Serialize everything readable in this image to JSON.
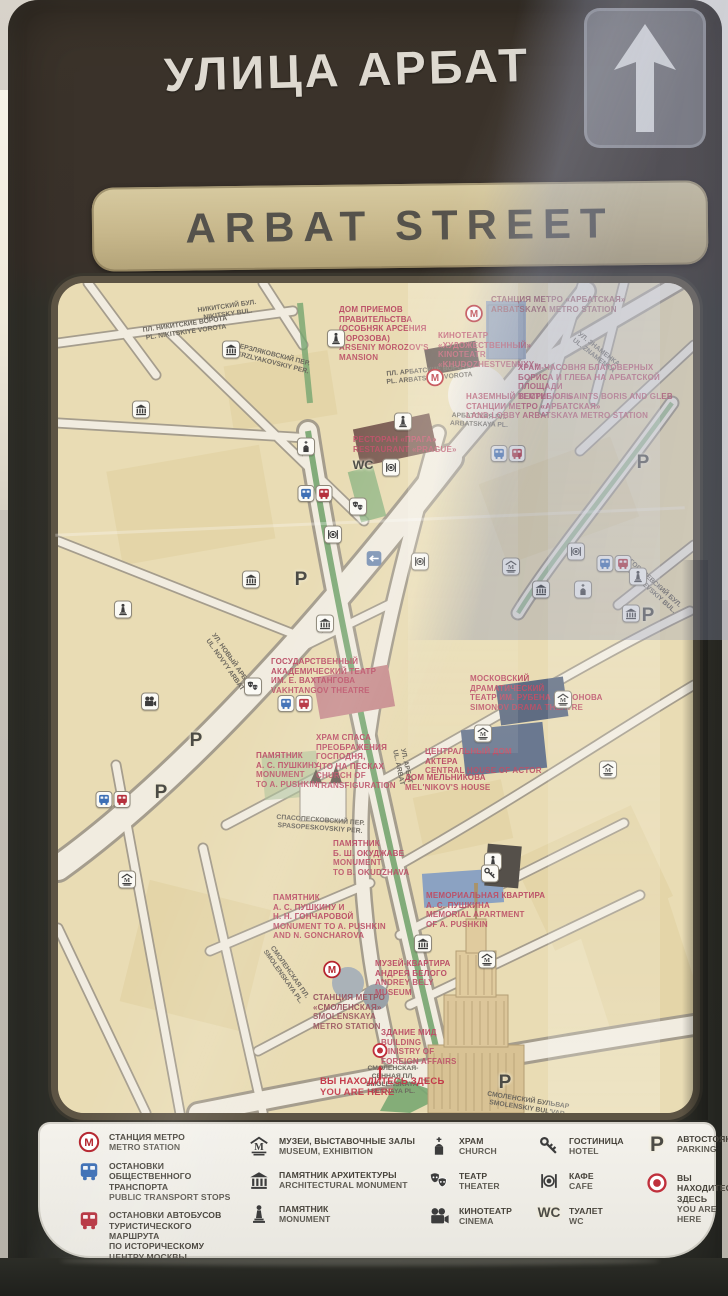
{
  "sign": {
    "title_ru": "УЛИЦА АРБАТ",
    "title_en": "ARBAT STREET",
    "arrow_icon": "up-arrow"
  },
  "colors": {
    "frame": "#2e2f29",
    "header_brown": "#3a322a",
    "gold": "#c7b78b",
    "map_cream": "#e9dcb4",
    "poi_red": "#bc5168",
    "metro_red": "#b5242e",
    "green": "#76a56f",
    "here_red": "#c43a4a",
    "bus_blue": "#3d6fb5",
    "bus_red": "#b5303d"
  },
  "map": {
    "poi_labels": [
      {
        "id": "arbatskaya-metro-label",
        "cls": "poi-metro",
        "x": 433,
        "y": 12,
        "ru": "СТАНЦИЯ МЕТРО «АРБАТСКАЯ»",
        "en": "ARBATSKAYA METRO STATION"
      },
      {
        "id": "morozov-mansion-label",
        "cls": "poi-red",
        "x": 281,
        "y": 22,
        "ru": "ДОМ ПРИЕМОВ\nПРАВИТЕЛЬСТВА\n(ОСОБНЯК АРСЕНИЯ\nМОРОЗОВА)",
        "en": "ARSENIY MOROZOV'S\nMANSION"
      },
      {
        "id": "khudozhestvennyy-cinema-label",
        "cls": "poi-red",
        "x": 380,
        "y": 48,
        "ru": "КИНОТЕАТР\n«ХУДОЖЕСТВЕННЫЙ»",
        "en": "KINOTEATR\n«KHUDOZHESTVENNYY»"
      },
      {
        "id": "boris-gleb-temple-label",
        "cls": "poi-red",
        "x": 460,
        "y": 80,
        "ru": "ХРАМ-ЧАСОВНЯ БЛАГОВЕРНЫХ\nБОРИСА И ГЛЕБА НА АРБАТСКОЙ ПЛОЩАДИ",
        "en": "TEMPLE OF SAINTS BORIS AND GLEB"
      },
      {
        "id": "land-lobby-label",
        "cls": "poi-red",
        "x": 408,
        "y": 109,
        "ru": "НАЗЕМНЫЙ ВЕСТИБЮЛЬ\nСТАНЦИИ МЕТРО «АРБАТСКАЯ»",
        "en": "LAND LOBBY ARBATSKAYA METRO STATION"
      },
      {
        "id": "restaurant-prague-label",
        "cls": "poi-red",
        "x": 295,
        "y": 152,
        "ru": "РЕСТОРАН «ПРАГА»",
        "en": "RESTAURANT «PRAGUE»"
      },
      {
        "id": "vakhtangov-theatre-label",
        "cls": "poi-red",
        "x": 213,
        "y": 374,
        "ru": "ГОСУДАРСТВЕННЫЙ\nАКАДЕМИЧЕСКИЙ ТЕАТР\nИМ. Е. ВАХТАНГОВА",
        "en": "VAKHTANGOV THEATRE"
      },
      {
        "id": "simonov-theatre-label",
        "cls": "poi-red",
        "x": 412,
        "y": 391,
        "ru": "МОСКОВСКИЙ\nДРАМАТИЧЕСКИЙ\nТЕАТР ИМ. РУБЕНА СИМОНОВА",
        "en": "SIMONOV DRAMA THEATRE"
      },
      {
        "id": "transfiguration-church-label",
        "cls": "poi-red",
        "x": 258,
        "y": 450,
        "ru": "ХРАМ СПАСА\nПРЕОБРАЖЕНИЯ\nГОСПОДНЯ,\nЧТО НА ПЕСКАХ",
        "en": "CHURCH OF\nTRANSFIGURATION"
      },
      {
        "id": "pushkin-monument-label",
        "cls": "poi-red",
        "x": 198,
        "y": 468,
        "ru": "ПАМЯТНИК\nА. С. ПУШКИНУ",
        "en": "MONUMENT\nTO A. PUSHKIN"
      },
      {
        "id": "house-of-actor-label",
        "cls": "poi-red",
        "x": 367,
        "y": 464,
        "ru": "ЦЕНТРАЛЬНЫЙ ДОМ\nАКТЕРА",
        "en": "CENTRAL HOUSE OF ACTOR"
      },
      {
        "id": "melnikov-house-label",
        "cls": "poi-red",
        "x": 347,
        "y": 490,
        "ru": "ДОМ МЕЛЬНИКОВА",
        "en": "MEL'NIKOV'S HOUSE"
      },
      {
        "id": "okudzhava-monument-label",
        "cls": "poi-red",
        "x": 275,
        "y": 556,
        "ru": "ПАМЯТНИК\nБ. Ш. ОКУДЖАВЕ",
        "en": "MONUMENT\nTO B. OKUDZHAVA"
      },
      {
        "id": "pushkin-goncharova-label",
        "cls": "poi-red",
        "x": 215,
        "y": 610,
        "ru": "ПАМЯТНИК\nА. С. ПУШКИНУ И\nН. Н. ГОНЧАРОВОЙ",
        "en": "MONUMENT TO A. PUSHKIN\nAND N. GONCHAROVA"
      },
      {
        "id": "pushkin-apartment-label",
        "cls": "poi-red",
        "x": 368,
        "y": 608,
        "ru": "МЕМОРИАЛЬНАЯ КВАРТИРА\nА. С. ПУШКИНА",
        "en": "MEMORIAL APARTMENT\nOF A. PUSHKIN"
      },
      {
        "id": "bely-museum-label",
        "cls": "poi-red",
        "x": 317,
        "y": 676,
        "ru": "МУЗЕЙ-КВАРТИРА\nАНДРЕЯ БЕЛОГО",
        "en": "ANDREY BELY\nMUSEUM"
      },
      {
        "id": "smolenskaya-metro-label",
        "cls": "poi-metro",
        "x": 255,
        "y": 710,
        "ru": "СТАНЦИЯ МЕТРО\n«СМОЛЕНСКАЯ»",
        "en": "SMOLENSKAYA\nMETRO STATION"
      },
      {
        "id": "mfa-building-label",
        "cls": "poi-red",
        "x": 323,
        "y": 745,
        "ru": "ЗДАНИЕ МИД",
        "en": "BUILDING\nMINISTRY OF\nFOREIGN AFFAIRS"
      },
      {
        "id": "you-are-here-label",
        "cls": "poi-here",
        "x": 262,
        "y": 793,
        "ru": "ВЫ НАХОДИТЕСЬ ЗДЕСЬ",
        "en": "YOU ARE HERE"
      }
    ],
    "street_labels": [
      {
        "id": "nikitsky-bul",
        "x": 140,
        "y": 20,
        "rot": -8,
        "ru": "НИКИТСКИЙ БУЛ.",
        "en": "NIKITSKY BUL."
      },
      {
        "id": "pl-nikitskie-vorota",
        "x": 85,
        "y": 38,
        "rot": -8,
        "ru": "ПЛ. НИКИТСКИЕ ВОРОТА",
        "en": "PL. NIKITSKIYE VOROTA"
      },
      {
        "id": "merzlyakovskiy-per",
        "x": 173,
        "y": 68,
        "rot": 14,
        "ru": "МЕРЗЛЯКОВСКИЙ ПЕР.",
        "en": "MERZLYAKOVSKIY PER."
      },
      {
        "id": "pl-arbatskie-vorota",
        "x": 328,
        "y": 84,
        "rot": -5,
        "ru": "ПЛ. АРБАТСКИЕ ВОРОТА",
        "en": "PL. ARBATSKIYE VOROTA"
      },
      {
        "id": "ul-znamenka",
        "x": 512,
        "y": 62,
        "rot": 38,
        "ru": "УЛ. ЗНАМЕНКА",
        "en": "UL. ZNAMENKA"
      },
      {
        "id": "arbatskaya-pl",
        "x": 392,
        "y": 130,
        "rot": 2,
        "ru": "АРБАТСКАЯ ПЛ.",
        "en": "ARBATSKAYA PL."
      },
      {
        "id": "ul-novy-arbat",
        "x": 138,
        "y": 372,
        "rot": 55,
        "ru": "УЛ. НОВЫЙ АРБАТ",
        "en": "UL. NOVYY ARBAT"
      },
      {
        "id": "gogolevskiy-bul",
        "x": 560,
        "y": 296,
        "rot": 42,
        "ru": "ГОГОЛЕВСКИЙ БУЛ.",
        "en": "GOGOLEVSKIY BUL."
      },
      {
        "id": "ul-arbat",
        "x": 326,
        "y": 476,
        "rot": 78,
        "ru": "УЛ. АРБАТ",
        "en": "UL. ARBAT"
      },
      {
        "id": "spasopeskovskiy-per",
        "x": 218,
        "y": 534,
        "rot": 4,
        "ru": "СПАСОПЕСКОВСКИЙ ПЕР.",
        "en": "SPASOPESKOVSKIY PER."
      },
      {
        "id": "smolenskaya-pl",
        "x": 196,
        "y": 684,
        "rot": 55,
        "ru": "СМОЛЕНСКАЯ ПЛ.",
        "en": "SMOLENSKAYA PL."
      },
      {
        "id": "smolenskaya-sennaya-pl",
        "x": 308,
        "y": 782,
        "rot": 0,
        "ru": "СМОЛЕНСКАЯ-\nСЕННАЯ ПЛ.",
        "en": "SMOLENSKAYA-\nSENNAYA PL."
      },
      {
        "id": "smolenskiy-bulvar",
        "x": 428,
        "y": 814,
        "rot": 9,
        "ru": "СМОЛЕНСКИЙ БУЛЬВАР",
        "en": "SMOLENSKIY BUL'VAR"
      }
    ],
    "icons": [
      {
        "type": "metro",
        "x": 416,
        "y": 33
      },
      {
        "type": "metro",
        "x": 377,
        "y": 97
      },
      {
        "type": "metro",
        "x": 274,
        "y": 689
      },
      {
        "type": "buspair",
        "x": 450,
        "y": 172
      },
      {
        "type": "buspair",
        "x": 257,
        "y": 212
      },
      {
        "type": "buspair",
        "x": 55,
        "y": 518
      },
      {
        "type": "buspair",
        "x": 237,
        "y": 422
      },
      {
        "type": "buspair",
        "x": 556,
        "y": 282
      },
      {
        "type": "museum",
        "x": 425,
        "y": 452
      },
      {
        "type": "museum",
        "x": 505,
        "y": 418
      },
      {
        "type": "museum",
        "x": 550,
        "y": 488
      },
      {
        "type": "museum",
        "x": 69,
        "y": 598
      },
      {
        "type": "museum",
        "x": 429,
        "y": 678
      },
      {
        "type": "museum",
        "x": 453,
        "y": 285
      },
      {
        "type": "arch",
        "x": 173,
        "y": 68
      },
      {
        "type": "arch",
        "x": 83,
        "y": 128
      },
      {
        "type": "arch",
        "x": 267,
        "y": 342
      },
      {
        "type": "arch",
        "x": 483,
        "y": 308
      },
      {
        "type": "arch",
        "x": 573,
        "y": 332
      },
      {
        "type": "arch",
        "x": 365,
        "y": 662
      },
      {
        "type": "arch",
        "x": 193,
        "y": 298
      },
      {
        "type": "monument",
        "x": 278,
        "y": 57
      },
      {
        "type": "monument",
        "x": 345,
        "y": 140
      },
      {
        "type": "monument",
        "x": 65,
        "y": 328
      },
      {
        "type": "monument",
        "x": 580,
        "y": 295
      },
      {
        "type": "monument",
        "x": 435,
        "y": 580
      },
      {
        "type": "church",
        "x": 248,
        "y": 165
      },
      {
        "type": "church",
        "x": 525,
        "y": 308
      },
      {
        "type": "theater",
        "x": 195,
        "y": 405
      },
      {
        "type": "theater",
        "x": 300,
        "y": 225
      },
      {
        "type": "cinema",
        "x": 92,
        "y": 420
      },
      {
        "type": "wc",
        "x": 305,
        "y": 182
      },
      {
        "type": "cafe",
        "x": 333,
        "y": 186
      },
      {
        "type": "cafe",
        "x": 362,
        "y": 280
      },
      {
        "type": "cafe",
        "x": 275,
        "y": 253
      },
      {
        "type": "cafe",
        "x": 518,
        "y": 270
      },
      {
        "type": "key",
        "x": 432,
        "y": 592
      },
      {
        "type": "parking",
        "x": 585,
        "y": 180
      },
      {
        "type": "parking",
        "x": 590,
        "y": 333
      },
      {
        "type": "parking",
        "x": 138,
        "y": 458
      },
      {
        "type": "parking",
        "x": 103,
        "y": 510
      },
      {
        "type": "parking",
        "x": 243,
        "y": 297
      },
      {
        "type": "parking",
        "x": 447,
        "y": 800
      },
      {
        "type": "turnarrow",
        "x": 316,
        "y": 278
      },
      {
        "type": "here",
        "x": 322,
        "y": 770
      },
      {
        "type": "herearrow",
        "x": 322,
        "y": 792
      }
    ],
    "icon_glyphs": {
      "metro": "М",
      "parking": "P",
      "wc": "WC",
      "museum": "M"
    }
  },
  "legend": {
    "columns": [
      {
        "left": 38,
        "top": 10,
        "width": 158,
        "gap": 8,
        "items": [
          {
            "icon": "metro",
            "id": "legend-metro",
            "ru": "СТАНЦИЯ МЕТРО",
            "en": "METRO STATION"
          },
          {
            "icon": "busblue",
            "id": "legend-public-transport",
            "ru": "ОСТАНОВКИ ОБЩЕСТВЕННОГО\nТРАНСПОРТА",
            "en": "PUBLIC TRANSPORT STOPS"
          },
          {
            "icon": "busred",
            "id": "legend-sightseeing-bus",
            "ru": "ОСТАНОВКИ АВТОБУСОВ\nТУРИСТИЧЕСКОГО МАРШРУТА\nПО ИСТОРИЧЕСКОМУ ЦЕНТРУ МОСКВЫ",
            "en": "CITY SIGHTSEENG'S STOPS"
          }
        ]
      },
      {
        "left": 208,
        "top": 14,
        "width": 170,
        "gap": 13,
        "items": [
          {
            "icon": "museum",
            "id": "legend-museum",
            "ru": "МУЗЕИ, ВЫСТАВОЧНЫЕ ЗАЛЫ",
            "en": "MUSEUM, EXHIBITION"
          },
          {
            "icon": "arch",
            "id": "legend-architectural-monument",
            "ru": "ПАМЯТНИК АРХИТЕКТУРЫ",
            "en": "ARCHITECTURAL MONUMENT"
          },
          {
            "icon": "monument",
            "id": "legend-monument",
            "ru": "ПАМЯТНИК",
            "en": "MONUMENT"
          }
        ]
      },
      {
        "left": 388,
        "top": 14,
        "width": 108,
        "gap": 14,
        "items": [
          {
            "icon": "church",
            "id": "legend-church",
            "ru": "ХРАМ",
            "en": "CHURCH"
          },
          {
            "icon": "theater",
            "id": "legend-theater",
            "ru": "ТЕАТР",
            "en": "THEATER"
          },
          {
            "icon": "cinema",
            "id": "legend-cinema",
            "ru": "КИНОТЕАТР",
            "en": "CINEMA"
          }
        ]
      },
      {
        "left": 498,
        "top": 14,
        "width": 102,
        "gap": 14,
        "items": [
          {
            "icon": "key",
            "id": "legend-hotel",
            "ru": "ГОСТИНИЦА",
            "en": "HOTEL"
          },
          {
            "icon": "cafe",
            "id": "legend-cafe",
            "ru": "КАФЕ",
            "en": "CAFE"
          },
          {
            "icon": "wc",
            "id": "legend-wc",
            "ru": "ТУАЛЕТ",
            "en": "WC"
          }
        ]
      },
      {
        "left": 606,
        "top": 12,
        "width": 98,
        "gap": 16,
        "items": [
          {
            "icon": "parking",
            "id": "legend-parking",
            "ru": "АВТОСТОЯНКА",
            "en": "PARKING"
          },
          {
            "icon": "here",
            "id": "legend-you-are-here",
            "ru": "ВЫ НАХОДИТЕСЬ ЗДЕСЬ",
            "en": "YOU ARE HERE"
          }
        ]
      }
    ]
  }
}
